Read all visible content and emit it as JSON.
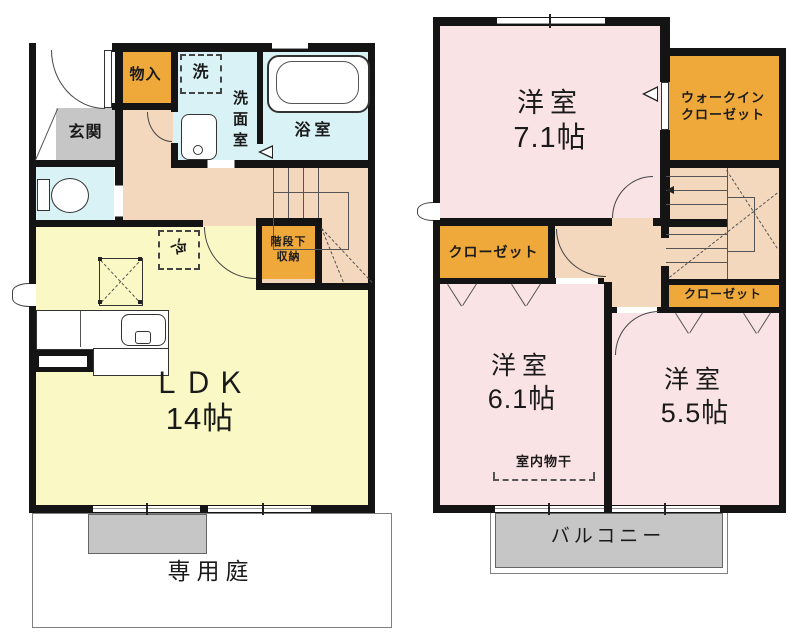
{
  "floor1": {
    "entrance": "玄関",
    "storage_closet": "物入",
    "washer": "洗",
    "washroom": "洗面室",
    "bathroom": "浴室",
    "fridge": "冷",
    "under_stair_line1": "階段下",
    "under_stair_line2": "収納",
    "ldk_name": "ＬＤＫ",
    "ldk_size": "14帖",
    "private_garden": "専用庭"
  },
  "floor2": {
    "bedroom1_name": "洋室",
    "bedroom1_size": "7.1帖",
    "wic_line1": "ウォークイン",
    "wic_line2": "クローゼット",
    "closet_left": "クローゼット",
    "closet_right": "クローゼット",
    "bedroom2_name": "洋室",
    "bedroom2_size": "6.1帖",
    "indoor_drying": "室内物干",
    "bedroom3_name": "洋室",
    "bedroom3_size": "5.5帖",
    "balcony": "バルコニー"
  },
  "colors": {
    "wall": "#141414",
    "ldk_yellow": "#FAF9C5",
    "hall_peach": "#F4D8BE",
    "wet_blue": "#D8F2F6",
    "bedroom_pink": "#FAE3E5",
    "closet_orange": "#EFA93B",
    "concrete_gray": "#C6C6C6"
  }
}
